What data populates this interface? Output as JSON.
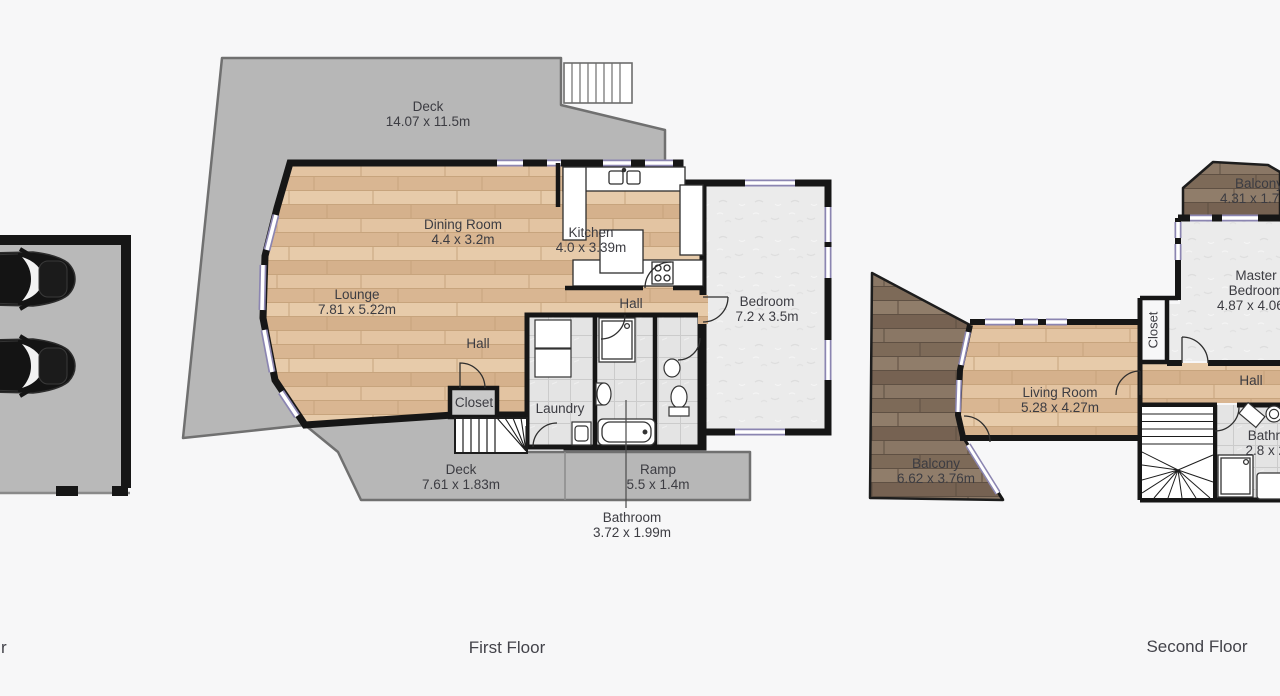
{
  "floors": {
    "garage": {
      "partial_label": "r"
    },
    "first": {
      "label": "First Floor",
      "rooms": {
        "deck_top": {
          "name": "Deck",
          "dims": "14.07 x 11.5m"
        },
        "dining": {
          "name": "Dining Room",
          "dims": "4.4 x 3.2m"
        },
        "kitchen": {
          "name": "Kitchen",
          "dims": "4.0 x 3.39m"
        },
        "lounge": {
          "name": "Lounge",
          "dims": "7.81 x 5.22m"
        },
        "hall_main": {
          "name": "Hall"
        },
        "hall_left": {
          "name": "Hall"
        },
        "bedroom": {
          "name": "Bedroom",
          "dims": "7.2 x 3.5m"
        },
        "closet": {
          "name": "Closet"
        },
        "laundry": {
          "name": "Laundry"
        },
        "deck_bottom": {
          "name": "Deck",
          "dims": "7.61 x 1.83m"
        },
        "ramp": {
          "name": "Ramp",
          "dims": "5.5 x 1.4m"
        },
        "bathroom": {
          "name": "Bathroom",
          "dims": "3.72 x 1.99m"
        }
      }
    },
    "second": {
      "label": "Second Floor",
      "rooms": {
        "balcony_top": {
          "name": "Balcony",
          "dims": "4.31 x 1.72m"
        },
        "master": {
          "name": "Master Bedroom",
          "dims": "4.87 x 4.06m"
        },
        "closet": {
          "name": "Closet"
        },
        "hall": {
          "name": "Hall"
        },
        "living": {
          "name": "Living Room",
          "dims": "5.28 x 4.27m"
        },
        "balcony_left": {
          "name": "Balcony",
          "dims": "6.62 x 3.76m"
        },
        "bathroom": {
          "name": "Bathroom",
          "dims": "2.8 x 2.6m"
        }
      }
    }
  },
  "colors": {
    "background": "#f7f7f8",
    "wall": "#161616",
    "window_accent": "#8b85b1",
    "deck_gray": "#b7b7b7",
    "wood_light": "#ddbb97",
    "wood_dark": "#81705f",
    "carpet": "#ebebeb",
    "tile": "#e3e3e3",
    "text": "#3c3c42"
  }
}
